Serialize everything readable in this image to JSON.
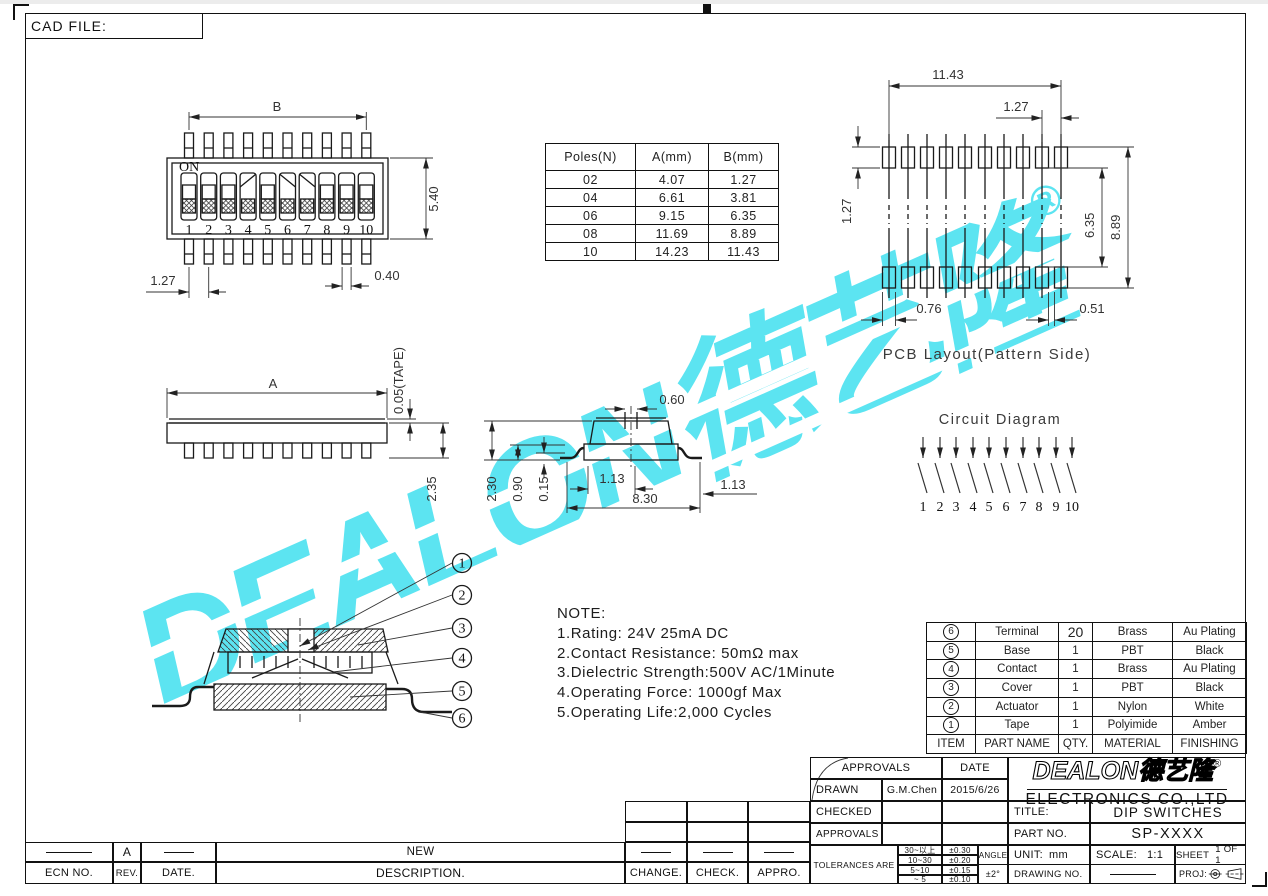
{
  "page": {
    "cad_file_label": "CAD FILE:"
  },
  "watermark": {
    "text": "DEALON德艺隆",
    "registered": "®",
    "color": "#5ce4f1"
  },
  "top_view": {
    "on_label": "ON",
    "positions": [
      "1",
      "2",
      "3",
      "4",
      "5",
      "6",
      "7",
      "8",
      "9",
      "10"
    ]
  },
  "dims": {
    "top_b": "B",
    "top_h": "5.40",
    "top_pitch": "1.27",
    "top_pin": "0.40",
    "side_a": "A",
    "side_tape": "0.05(TAPE)",
    "side_h": "2.35",
    "sec_top": "0.60",
    "sec_h": "2.30",
    "sec_mid": "0.90",
    "sec_standoff": "0.15",
    "sec_lead_l": "1.13",
    "sec_w": "8.30",
    "sec_lead_r": "1.13",
    "pcb_w": "11.43",
    "pcb_pitch": "1.27",
    "pcb_pad_h": "1.27",
    "pcb_inner": "6.35",
    "pcb_outer": "8.89",
    "pcb_pad_w": "0.76",
    "pcb_gap": "0.51"
  },
  "poles_table": {
    "headers": [
      "Poles(N)",
      "A(mm)",
      "B(mm)"
    ],
    "rows": [
      [
        "02",
        "4.07",
        "1.27"
      ],
      [
        "04",
        "6.61",
        "3.81"
      ],
      [
        "06",
        "9.15",
        "6.35"
      ],
      [
        "08",
        "11.69",
        "8.89"
      ],
      [
        "10",
        "14.23",
        "11.43"
      ]
    ]
  },
  "pcb": {
    "title": "PCB Layout(Pattern Side)"
  },
  "circuit": {
    "title": "Circuit Diagram",
    "positions": [
      "1",
      "2",
      "3",
      "4",
      "5",
      "6",
      "7",
      "8",
      "9",
      "10"
    ]
  },
  "notes": {
    "title": "NOTE:",
    "lines": [
      "1.Rating: 24V 25mA DC",
      "2.Contact Resistance: 50mΩ max",
      "3.Dielectric Strength:500V AC/1Minute",
      "4.Operating Force: 1000gf Max",
      "5.Operating Life:2,000 Cycles"
    ]
  },
  "callouts": [
    "1",
    "2",
    "3",
    "4",
    "5",
    "6"
  ],
  "bom": {
    "headers": [
      "ITEM",
      "PART NAME",
      "QTY.",
      "MATERIAL",
      "FINISHING"
    ],
    "rows": [
      {
        "item": "6",
        "name": "Terminal",
        "qty": "20",
        "material": "Brass",
        "finish": "Au Plating"
      },
      {
        "item": "5",
        "name": "Base",
        "qty": "1",
        "material": "PBT",
        "finish": "Black"
      },
      {
        "item": "4",
        "name": "Contact",
        "qty": "1",
        "material": "Brass",
        "finish": "Au Plating"
      },
      {
        "item": "3",
        "name": "Cover",
        "qty": "1",
        "material": "PBT",
        "finish": "Black"
      },
      {
        "item": "2",
        "name": "Actuator",
        "qty": "1",
        "material": "Nylon",
        "finish": "White"
      },
      {
        "item": "1",
        "name": "Tape",
        "qty": "1",
        "material": "Polyimide",
        "finish": "Amber"
      }
    ]
  },
  "title_block": {
    "approvals_label": "APPROVALS",
    "date_label": "DATE",
    "drawn_label": "DRAWN",
    "drawn_by": "G.M.Chen",
    "drawn_date": "2015/6/26",
    "checked_label": "CHECKED",
    "approved_label": "APPROVALS",
    "tolerances_label": "TOLERANCES ARE",
    "tolerance_rows": [
      [
        "30~以上",
        "±0.30"
      ],
      [
        "10~30",
        "±0.20"
      ],
      [
        "5~10",
        "±0.15"
      ],
      [
        "~ 5",
        "±0.10"
      ]
    ],
    "angle_label": "ANGLE",
    "angle_value": "±2°",
    "logo_text": "DEALON德艺隆",
    "registered": "®",
    "company_name": "ELECTRONICS CO.,LTD",
    "title_label": "TITLE:",
    "title_value": "DIP SWITCHES",
    "part_no_label": "PART NO.",
    "part_no_value": "SP-XXXX",
    "unit_label": "UNIT:",
    "unit_value": "mm",
    "scale_label": "SCALE:",
    "scale_value": "1:1",
    "sheet_label": "SHEET",
    "sheet_value": "1 OF 1",
    "drawing_no_label": "DRAWING NO.",
    "proj_label": "PROJ:"
  },
  "revision": {
    "headers": [
      "ECN NO.",
      "REV.",
      "DATE.",
      "DESCRIPTION.",
      "CHANGE.",
      "CHECK.",
      "APPRO."
    ],
    "entry": {
      "rev": "A",
      "description": "NEW"
    }
  }
}
